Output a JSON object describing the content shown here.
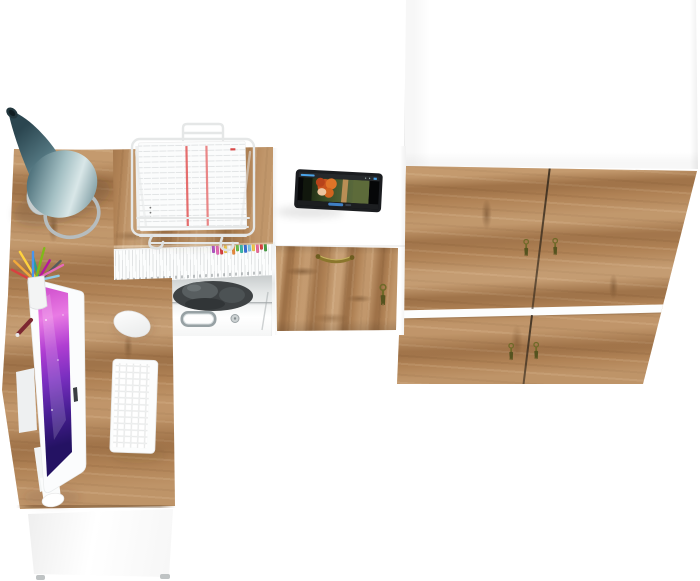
{
  "scene": {
    "type": "3d furniture render, top view",
    "objects": [
      "wardrobe",
      "corner-desk",
      "desk-lamp",
      "document-wire-rack",
      "tablet",
      "all-in-one-computer",
      "keyboard",
      "mouse",
      "pen-cup",
      "office-chair",
      "binder-row"
    ]
  },
  "colors": {
    "background": "#ffffff",
    "wood_base": "#b08255",
    "wood_dark": "#7c5530",
    "wood_light": "#d8b488",
    "white_panel": "#ffffff",
    "lamp_dark": "#2b4650",
    "lamp_light": "#d9e7e8",
    "lamp_base": "#c7cdce",
    "chair": "#3e4244",
    "screen_pink": "#e97ae4",
    "screen_purple": "#7a2fc0",
    "screen_dark": "#241263",
    "brass": "#8a762c",
    "key_olive": "#6f6a28",
    "key_tassel": "#55531f",
    "metal_handle": "#97a1a4",
    "tablet_body": "#1b1d20",
    "video_blue": "#4aa3e8",
    "paper_red": "#e25555",
    "wire": "#e5e7e7"
  },
  "wardrobe": {
    "door_count": 4,
    "key_count": 4,
    "top_material": "white",
    "front_material": "oak"
  },
  "desk": {
    "binder_color": "white",
    "marker_tip_colors": [
      "#b455c8",
      "#e86ab8",
      "#d94040",
      "#f2c84b",
      "#ffffff",
      "#e8893a",
      "#6cc04a",
      "#3bb8a8",
      "#3a6fd8",
      "#7ac3e8",
      "#f2c84b",
      "#e86a9a",
      "#d94040",
      "#4a9e46"
    ],
    "pen_colors": [
      "#d94040",
      "#f2a93b",
      "#ffd23e",
      "#2a9d8f",
      "#4895ef",
      "#80b918",
      "#b5179e",
      "#555a5e",
      "#e86ab8",
      "#8ecae6"
    ]
  },
  "tablet": {
    "video_subject": "animated movie scene",
    "accent": "#4aa3e8"
  }
}
